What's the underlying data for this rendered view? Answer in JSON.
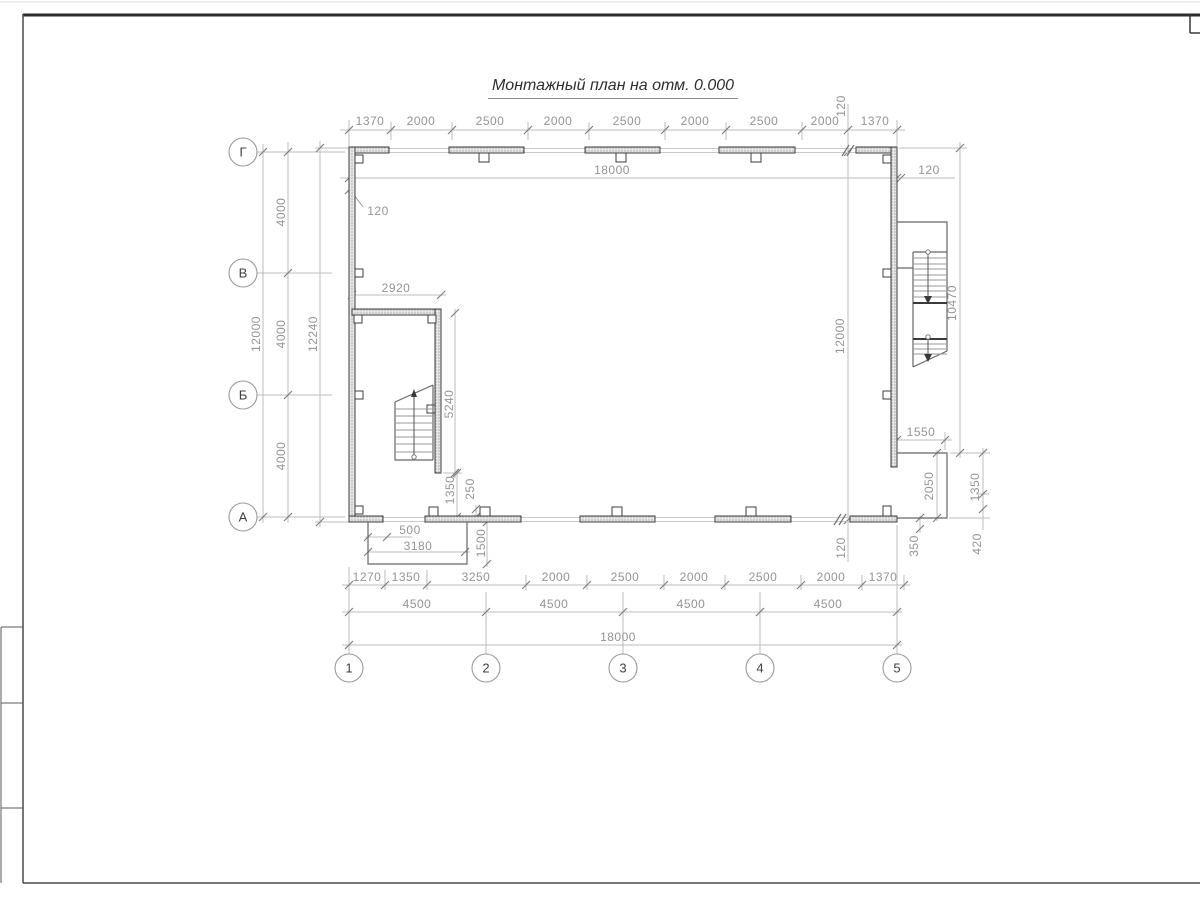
{
  "title": "Монтажный план на отм. 0.000",
  "axes": {
    "rows": [
      "Г",
      "В",
      "Б",
      "А"
    ],
    "cols": [
      "1",
      "2",
      "3",
      "4",
      "5"
    ]
  },
  "dims": {
    "top_row": [
      "1370",
      "2000",
      "2500",
      "2000",
      "2500",
      "2000",
      "2500",
      "2000"
    ],
    "top_120": "120",
    "top_last": "1370",
    "top_total": "18000",
    "top_right_wall": "120",
    "left_wall": "120",
    "left_total": "12000",
    "left_four": [
      "4000",
      "4000",
      "4000"
    ],
    "left_overall": "12240",
    "inner_width": "2920",
    "inner_height": "5240",
    "inner_offset": "1350",
    "inner_gap": "250",
    "porch_offset": "500",
    "porch_width": "3180",
    "porch_depth": "1500",
    "bottom_row1": [
      "1270",
      "1350",
      "3250",
      "2000",
      "2500",
      "2000",
      "2500",
      "2000",
      "1370"
    ],
    "bottom_row2": [
      "4500",
      "4500",
      "4500",
      "4500"
    ],
    "bottom_total": "18000",
    "right_inner_height": "12000",
    "right_stair_height": "10470",
    "right_annex_width": "1550",
    "right_annex_height": "2050",
    "right_1350": "1350",
    "right_420": "420",
    "right_350": "350",
    "right_wall_120": "120"
  }
}
